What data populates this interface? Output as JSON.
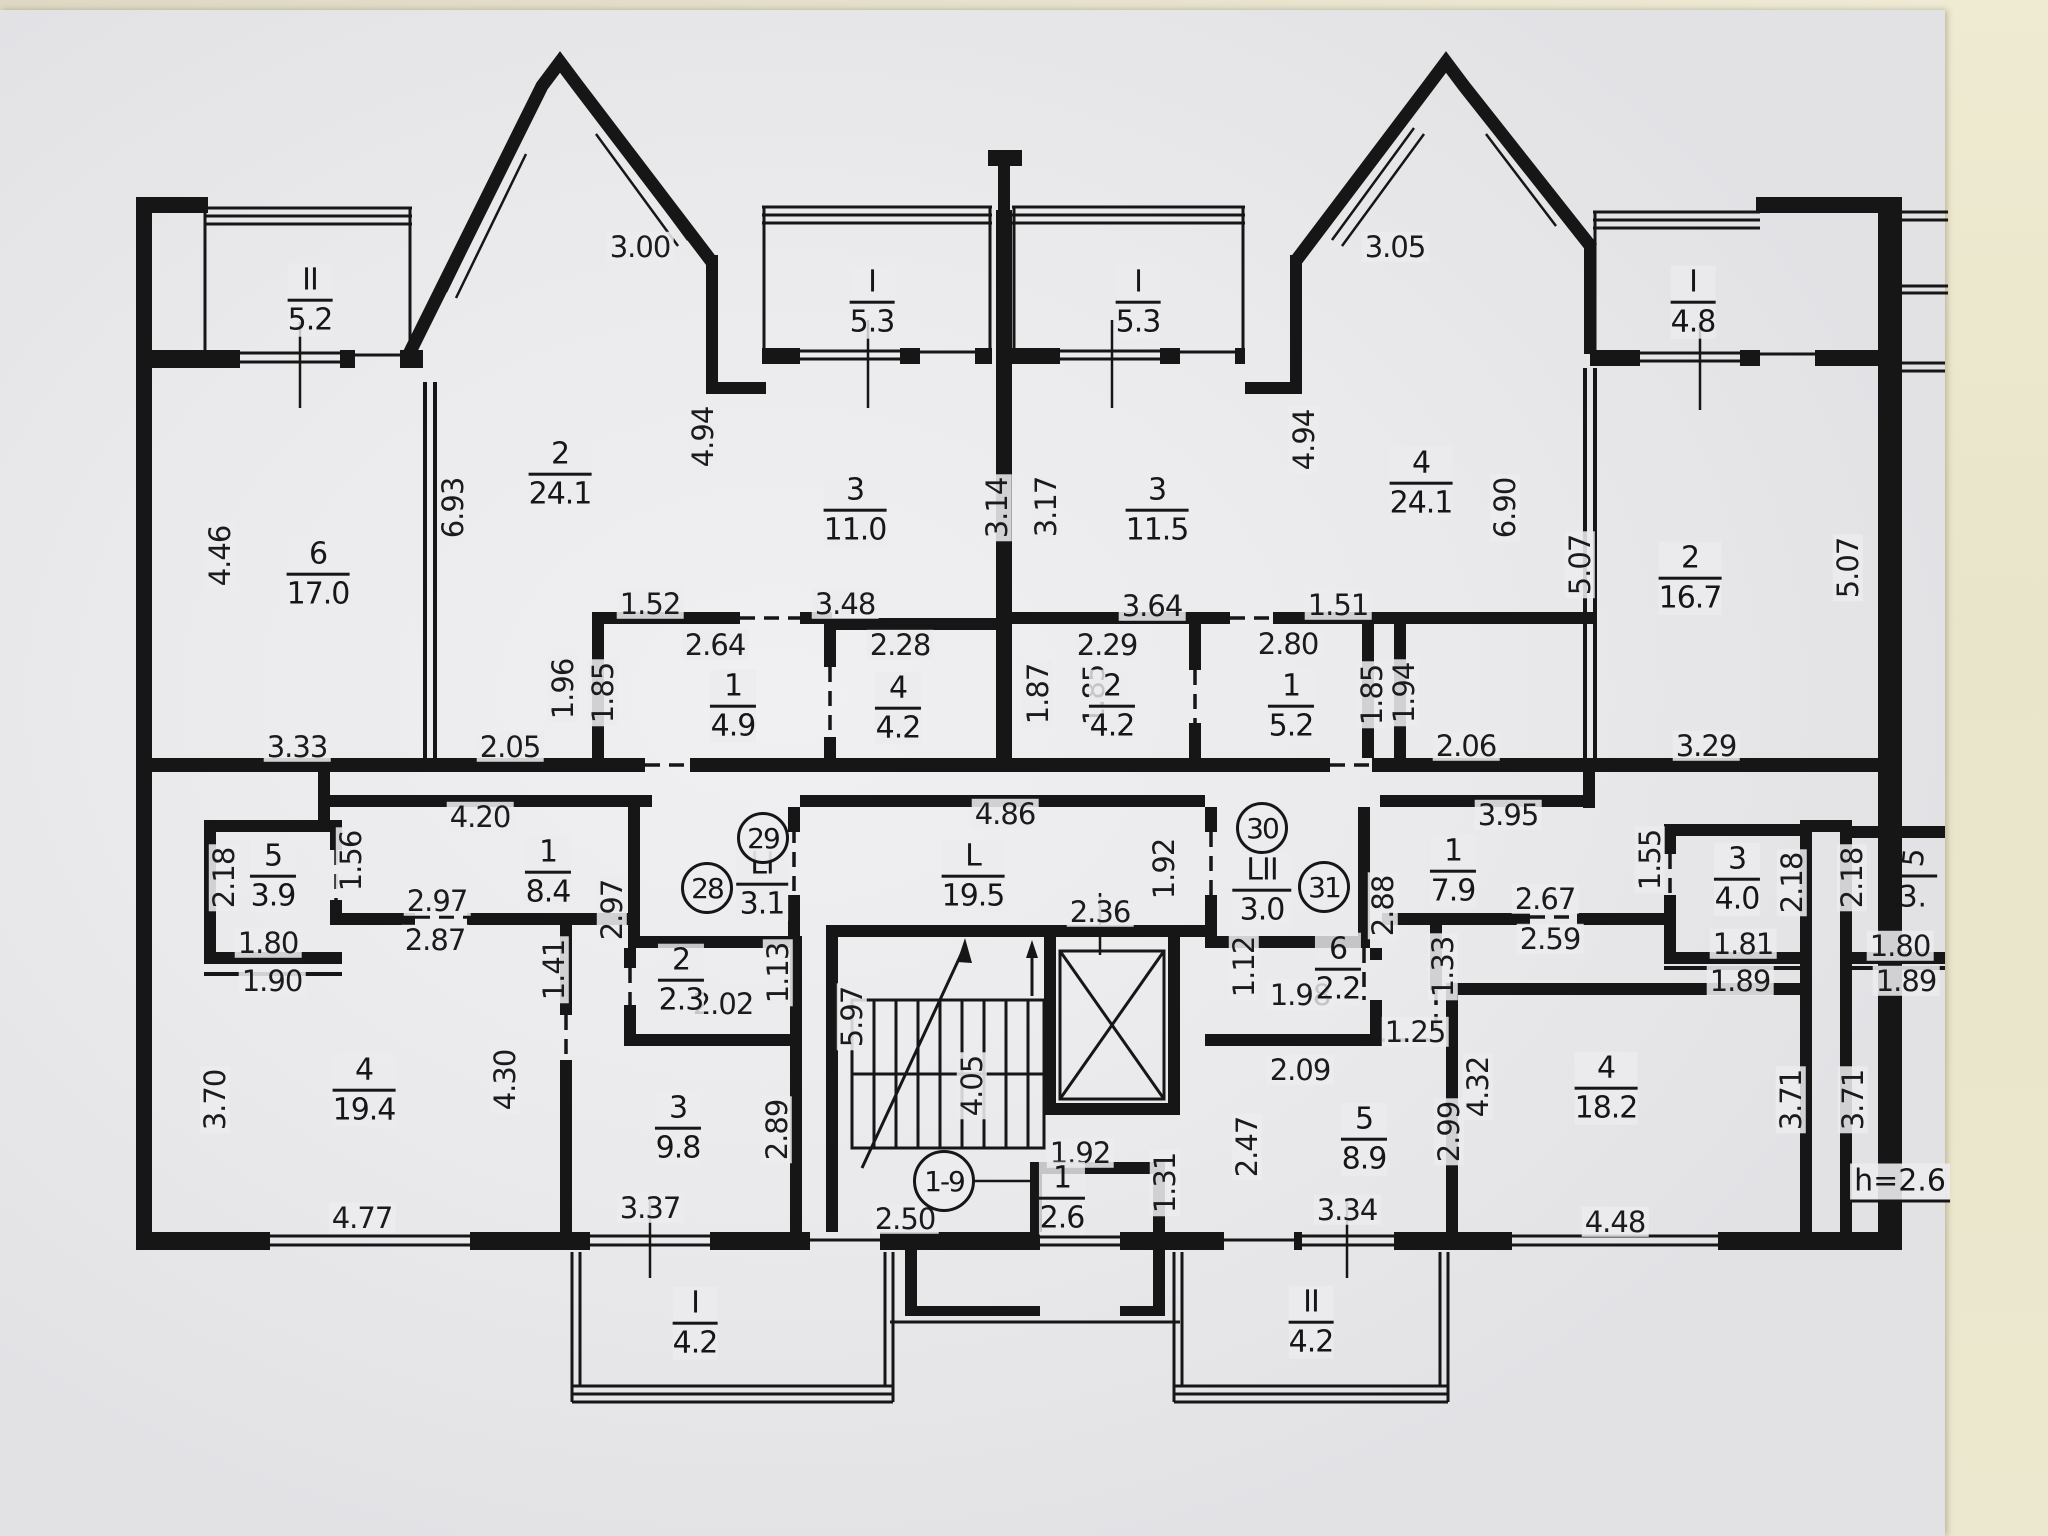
{
  "drawing": {
    "type": "apartment-building-floor-plan",
    "ceiling_note": "h=2.6",
    "entrance_circle": "1-9",
    "cut_room": {
      "num": "5",
      "den": "3."
    }
  },
  "colors": {
    "ink": "#161616",
    "paper": "#ececee",
    "wall_bg": "#e9e5ca"
  },
  "circles": [
    {
      "t": "28",
      "x": 707,
      "y": 888
    },
    {
      "t": "29",
      "x": 763,
      "y": 838
    },
    {
      "t": "30",
      "x": 1262,
      "y": 828
    },
    {
      "t": "31",
      "x": 1324,
      "y": 887
    },
    {
      "t": "1-9",
      "x": 944,
      "y": 1181,
      "big": true
    }
  ],
  "rooms": [
    {
      "num": "II",
      "den": "5.2",
      "x": 310,
      "y": 300
    },
    {
      "num": "I",
      "den": "5.3",
      "x": 872,
      "y": 302
    },
    {
      "num": "I",
      "den": "5.3",
      "x": 1138,
      "y": 302
    },
    {
      "num": "I",
      "den": "4.8",
      "x": 1693,
      "y": 302
    },
    {
      "num": "6",
      "den": "17.0",
      "x": 318,
      "y": 574
    },
    {
      "num": "2",
      "den": "24.1",
      "x": 560,
      "y": 474
    },
    {
      "num": "3",
      "den": "11.0",
      "x": 855,
      "y": 510
    },
    {
      "num": "3",
      "den": "11.5",
      "x": 1157,
      "y": 510
    },
    {
      "num": "4",
      "den": "24.1",
      "x": 1421,
      "y": 483
    },
    {
      "num": "2",
      "den": "16.7",
      "x": 1690,
      "y": 578
    },
    {
      "num": "1",
      "den": "4.9",
      "x": 733,
      "y": 706
    },
    {
      "num": "4",
      "den": "4.2",
      "x": 898,
      "y": 708
    },
    {
      "num": "2",
      "den": "4.2",
      "x": 1112,
      "y": 706
    },
    {
      "num": "1",
      "den": "5.2",
      "x": 1291,
      "y": 706
    },
    {
      "num": "5",
      "den": "3.9",
      "x": 273,
      "y": 876
    },
    {
      "num": "1",
      "den": "8.4",
      "x": 548,
      "y": 872
    },
    {
      "num": "LI",
      "den": "3.1",
      "x": 762,
      "y": 884
    },
    {
      "num": "L",
      "den": "19.5",
      "x": 973,
      "y": 876
    },
    {
      "num": "LII",
      "den": "3.0",
      "x": 1262,
      "y": 890
    },
    {
      "num": "1",
      "den": "7.9",
      "x": 1453,
      "y": 871
    },
    {
      "num": "3",
      "den": "4.0",
      "x": 1737,
      "y": 879
    },
    {
      "num": "2",
      "den": "2.3",
      "x": 681,
      "y": 980
    },
    {
      "num": "6",
      "den": "2.2",
      "x": 1338,
      "y": 969
    },
    {
      "num": "4",
      "den": "19.4",
      "x": 364,
      "y": 1090
    },
    {
      "num": "3",
      "den": "9.8",
      "x": 678,
      "y": 1128
    },
    {
      "num": "5",
      "den": "8.9",
      "x": 1364,
      "y": 1139
    },
    {
      "num": "4",
      "den": "18.2",
      "x": 1606,
      "y": 1088
    },
    {
      "num": "1",
      "den": "2.6",
      "x": 1062,
      "y": 1198
    },
    {
      "num": "I",
      "den": "4.2",
      "x": 695,
      "y": 1323
    },
    {
      "num": "II",
      "den": "4.2",
      "x": 1311,
      "y": 1322
    }
  ],
  "labels": [
    {
      "t": "3.00",
      "x": 640,
      "y": 247
    },
    {
      "t": "3.05",
      "x": 1395,
      "y": 247
    },
    {
      "t": "4.46",
      "x": 220,
      "y": 556,
      "r": -90
    },
    {
      "t": "6.93",
      "x": 453,
      "y": 508,
      "r": -90
    },
    {
      "t": "4.94",
      "x": 703,
      "y": 437,
      "r": -90
    },
    {
      "t": "3.14",
      "x": 997,
      "y": 508,
      "r": -90
    },
    {
      "t": "3.17",
      "x": 1046,
      "y": 507,
      "r": -90
    },
    {
      "t": "4.94",
      "x": 1304,
      "y": 440,
      "r": -90
    },
    {
      "t": "6.90",
      "x": 1505,
      "y": 508,
      "r": -90
    },
    {
      "t": "5.07",
      "x": 1580,
      "y": 565,
      "r": -90
    },
    {
      "t": "5.07",
      "x": 1848,
      "y": 568,
      "r": -90
    },
    {
      "t": "1.52",
      "x": 650,
      "y": 604
    },
    {
      "t": "3.48",
      "x": 845,
      "y": 604
    },
    {
      "t": "3.64",
      "x": 1152,
      "y": 606
    },
    {
      "t": "1.51",
      "x": 1338,
      "y": 605
    },
    {
      "t": "2.64",
      "x": 715,
      "y": 645
    },
    {
      "t": "2.28",
      "x": 900,
      "y": 645
    },
    {
      "t": "2.29",
      "x": 1107,
      "y": 645
    },
    {
      "t": "2.80",
      "x": 1288,
      "y": 644
    },
    {
      "t": "1.96",
      "x": 563,
      "y": 689,
      "r": -90
    },
    {
      "t": "1.85",
      "x": 603,
      "y": 693,
      "r": -90
    },
    {
      "t": "1.85",
      "x": 1094,
      "y": 695,
      "r": -90
    },
    {
      "t": "1.87",
      "x": 1038,
      "y": 694,
      "r": -90
    },
    {
      "t": "1.85",
      "x": 1372,
      "y": 695,
      "r": -90
    },
    {
      "t": "1.94",
      "x": 1404,
      "y": 693,
      "r": -90
    },
    {
      "t": "3.33",
      "x": 297,
      "y": 747
    },
    {
      "t": "2.05",
      "x": 510,
      "y": 747
    },
    {
      "t": "2.06",
      "x": 1466,
      "y": 746
    },
    {
      "t": "3.29",
      "x": 1706,
      "y": 746
    },
    {
      "t": "4.20",
      "x": 480,
      "y": 817
    },
    {
      "t": "4.86",
      "x": 1005,
      "y": 814
    },
    {
      "t": "3.95",
      "x": 1508,
      "y": 815
    },
    {
      "t": "2.18",
      "x": 224,
      "y": 878,
      "r": -90
    },
    {
      "t": "1.56",
      "x": 351,
      "y": 861,
      "r": -90
    },
    {
      "t": "2.97",
      "x": 437,
      "y": 901
    },
    {
      "t": "2.87",
      "x": 435,
      "y": 940
    },
    {
      "t": "2.97",
      "x": 612,
      "y": 910,
      "r": -90
    },
    {
      "t": "1.92",
      "x": 1164,
      "y": 869,
      "r": -90
    },
    {
      "t": "2.88",
      "x": 1383,
      "y": 906,
      "r": -90
    },
    {
      "t": "2.67",
      "x": 1545,
      "y": 899
    },
    {
      "t": "2.59",
      "x": 1550,
      "y": 939
    },
    {
      "t": "1.55",
      "x": 1650,
      "y": 860,
      "r": -90
    },
    {
      "t": "2.18",
      "x": 1792,
      "y": 883,
      "r": -90
    },
    {
      "t": "2.18",
      "x": 1852,
      "y": 878,
      "r": -90
    },
    {
      "t": "1.80",
      "x": 268,
      "y": 943
    },
    {
      "t": "1.90",
      "x": 272,
      "y": 981
    },
    {
      "t": "1.81",
      "x": 1743,
      "y": 944
    },
    {
      "t": "1.89",
      "x": 1740,
      "y": 981
    },
    {
      "t": "1.80",
      "x": 1900,
      "y": 946
    },
    {
      "t": "1.89",
      "x": 1906,
      "y": 981
    },
    {
      "t": "1.41",
      "x": 554,
      "y": 970,
      "r": -90
    },
    {
      "t": "1.13",
      "x": 778,
      "y": 973,
      "r": -90
    },
    {
      "t": "2.36",
      "x": 1100,
      "y": 912
    },
    {
      "t": "1.12",
      "x": 1244,
      "y": 967,
      "r": -90
    },
    {
      "t": "1.33",
      "x": 1443,
      "y": 967,
      "r": -90
    },
    {
      "t": "1.98",
      "x": 1300,
      "y": 995
    },
    {
      "t": "2.02",
      "x": 723,
      "y": 1004
    },
    {
      "t": "1.25",
      "x": 1415,
      "y": 1032
    },
    {
      "t": "2.09",
      "x": 1300,
      "y": 1070
    },
    {
      "t": "5.97",
      "x": 852,
      "y": 1017,
      "r": -90
    },
    {
      "t": "4.05",
      "x": 972,
      "y": 1086,
      "r": -90
    },
    {
      "t": "2.89",
      "x": 777,
      "y": 1130,
      "r": -90
    },
    {
      "t": "4.30",
      "x": 505,
      "y": 1080,
      "r": -90
    },
    {
      "t": "3.70",
      "x": 215,
      "y": 1100,
      "r": -90
    },
    {
      "t": "4.32",
      "x": 1478,
      "y": 1087,
      "r": -90
    },
    {
      "t": "2.47",
      "x": 1247,
      "y": 1147,
      "r": -90
    },
    {
      "t": "2.99",
      "x": 1449,
      "y": 1132,
      "r": -90
    },
    {
      "t": "3.71",
      "x": 1791,
      "y": 1100,
      "r": -90
    },
    {
      "t": "3.71",
      "x": 1853,
      "y": 1100,
      "r": -90
    },
    {
      "t": "1.92",
      "x": 1080,
      "y": 1153
    },
    {
      "t": "1.31",
      "x": 1165,
      "y": 1183,
      "r": -90
    },
    {
      "t": "2.50",
      "x": 905,
      "y": 1219
    },
    {
      "t": "3.37",
      "x": 650,
      "y": 1208
    },
    {
      "t": "3.34",
      "x": 1347,
      "y": 1210
    },
    {
      "t": "4.77",
      "x": 362,
      "y": 1218
    },
    {
      "t": "4.48",
      "x": 1615,
      "y": 1222
    }
  ]
}
